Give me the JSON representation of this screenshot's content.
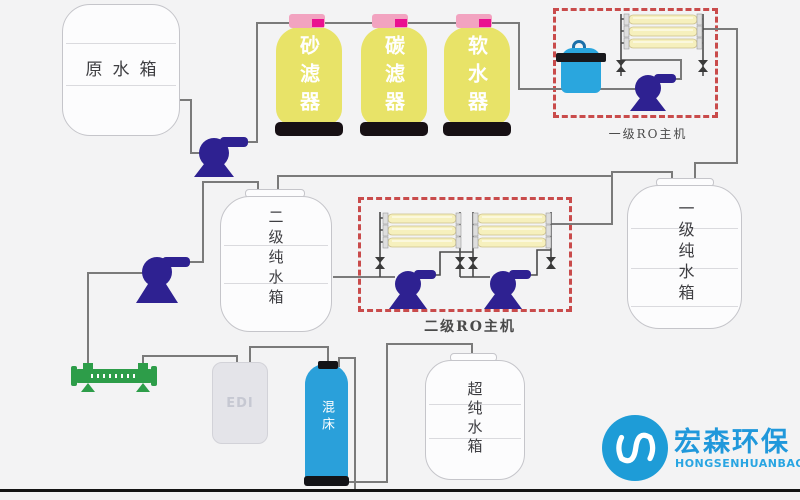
{
  "labels": {
    "raw_water_tank": "原水箱",
    "sand_filter": "砂滤器",
    "carbon_filter": "碳滤器",
    "water_softener": "软水器",
    "ro_stage1": "一级RO主机",
    "ro_stage2": "二级RO主机",
    "pure_tank_stage1": "一级纯水箱",
    "pure_tank_stage2": "二级纯水箱",
    "ultra_pure_tank": "超纯水箱",
    "mixed_bed": "混床",
    "edi": "EDI"
  },
  "logo": {
    "name_cn": "宏森环保",
    "name_en": "HONGSENHUANBAO"
  },
  "colors": {
    "background": "#f3f3f4",
    "vessel_yellow": "#e8e368",
    "vessel_cap_pink": "#f2a3c0",
    "vessel_cap_magenta": "#ea1090",
    "pump_indigo": "#2e2191",
    "membrane_yellow": "#f6f0bd",
    "equipment_blue": "#2aa3dc",
    "uv_green": "#2d9d49",
    "ro_box_red": "#c94b4b",
    "pipe_gray": "#7a7a7a",
    "logo_blue": "#1e9cd7"
  }
}
